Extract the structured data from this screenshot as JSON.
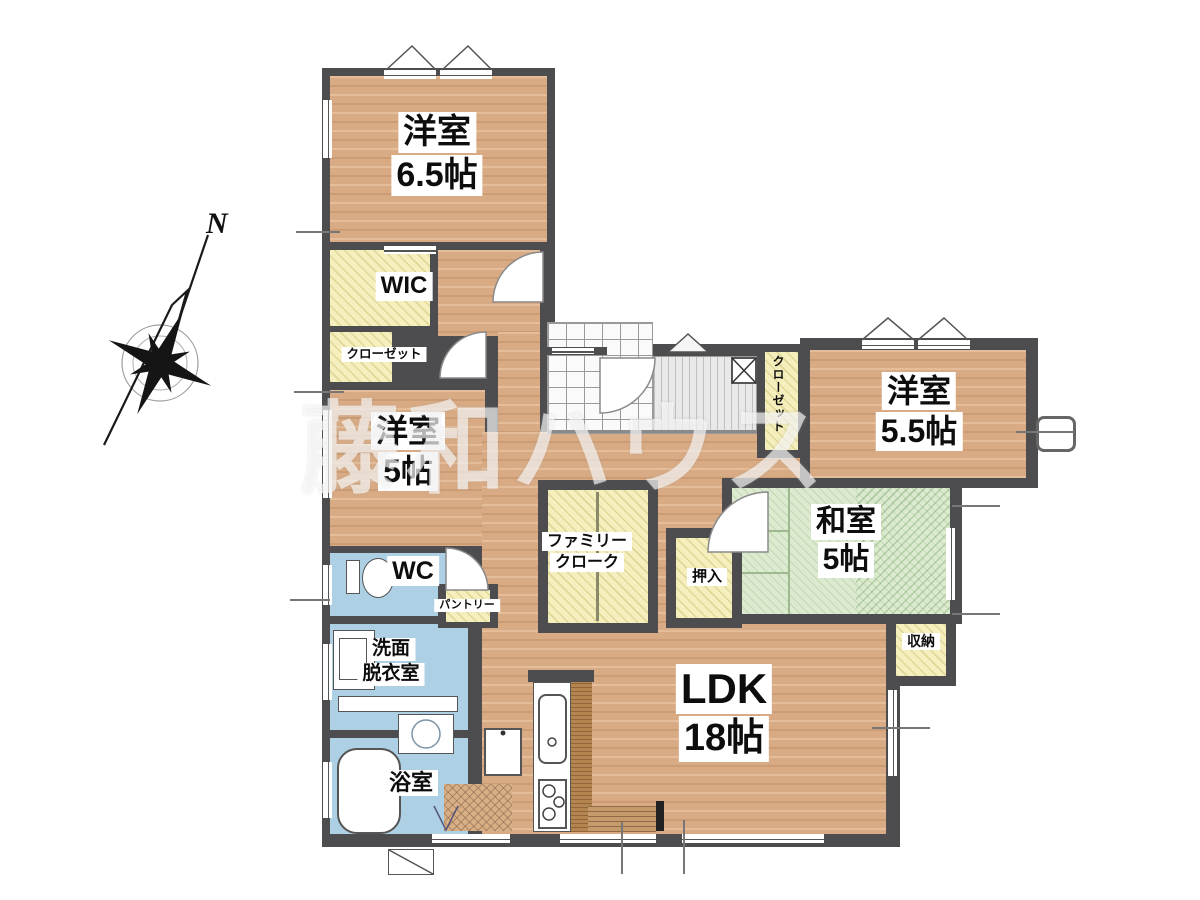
{
  "watermark": "藤和ハウス",
  "compass": {
    "label": "N"
  },
  "rooms": {
    "yoshitsu65": {
      "name": "洋室",
      "size": "6.5帖"
    },
    "wic": {
      "name": "WIC"
    },
    "closet": {
      "name": "クローゼット"
    },
    "yoshitsu5": {
      "name": "洋室",
      "size": "5帖"
    },
    "wc": {
      "name": "WC"
    },
    "senmen": {
      "line1": "洗面",
      "line2": "脱衣室"
    },
    "bath": {
      "name": "浴室"
    },
    "pantry": {
      "name": "パントリー"
    },
    "familycloak": {
      "line1": "ファミリー",
      "line2": "クローク"
    },
    "oshiire": {
      "name": "押入"
    },
    "washitsu": {
      "name": "和室",
      "size": "5帖"
    },
    "closet_vertical": {
      "name": "クローゼット"
    },
    "shuno": {
      "name": "収納"
    },
    "yoshitsu55": {
      "name": "洋室",
      "size": "5.5帖"
    },
    "ldk": {
      "name": "LDK",
      "size": "18帖"
    }
  },
  "colors": {
    "wall": "#4d4d50",
    "wood_floor": "#d9ab84",
    "closet_yellow": "#f5efbe",
    "tatami_green": "#dcead0",
    "wet_blue": "#aed0e4",
    "background": "#ffffff",
    "watermark_white": "rgba(255,255,255,0.62)"
  }
}
